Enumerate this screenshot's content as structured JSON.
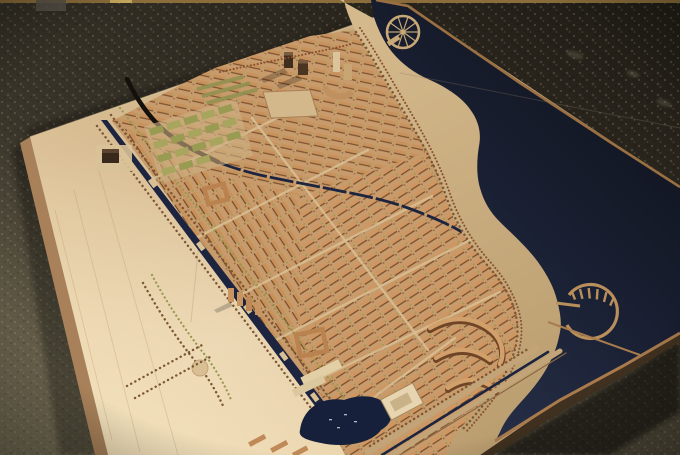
{
  "scene": {
    "description": "Photograph of a wooden architectural scale model of a riverside urban master plan, displayed flat on a dark speckled stone gallery floor",
    "labels": {
      "floor": "gallery floor",
      "board": "model baseboard",
      "river": "river",
      "wheel_pier": "circular wheel pier",
      "marina": "semicircular marina with finger piers",
      "esplanade": "riverfront esplanade",
      "city": "city building blocks",
      "boulevard": "tree-lined canal boulevard",
      "arc_road": "curved black road",
      "lagoon": "lagoon with boats",
      "landmark": "cream landmark building",
      "orchard": "garden plots",
      "towers": "high-rise tower cluster"
    }
  },
  "colors": {
    "floor_dark": "#221e17",
    "floor_light": "#7b745a",
    "floor_mid": "#4e483a",
    "gold_trim": "#8a6d3a",
    "gold_trim_bright": "#c6a75e",
    "wood": "#d8bc92",
    "wood_bright": "#f0dcb4",
    "wood_dim": "#c2a478",
    "wood_edge": "#a8815a",
    "rim": "#9a6f42",
    "water_far": "#0d1017",
    "water_mid": "#1a2033",
    "water_near": "#273049",
    "sand": "#c9ad80",
    "city_base": "#c79b6c",
    "building": "#cf9660",
    "building_shadow": "#6e4526",
    "tree_green": "#97984f",
    "tree_brown": "#7a5634",
    "road": "#d8c094",
    "canal": "#1c2440",
    "road_black": "#14110d",
    "cream": "#e6d5b0",
    "dark_tower": "#4a3422",
    "boat": "#cfd4d6"
  }
}
